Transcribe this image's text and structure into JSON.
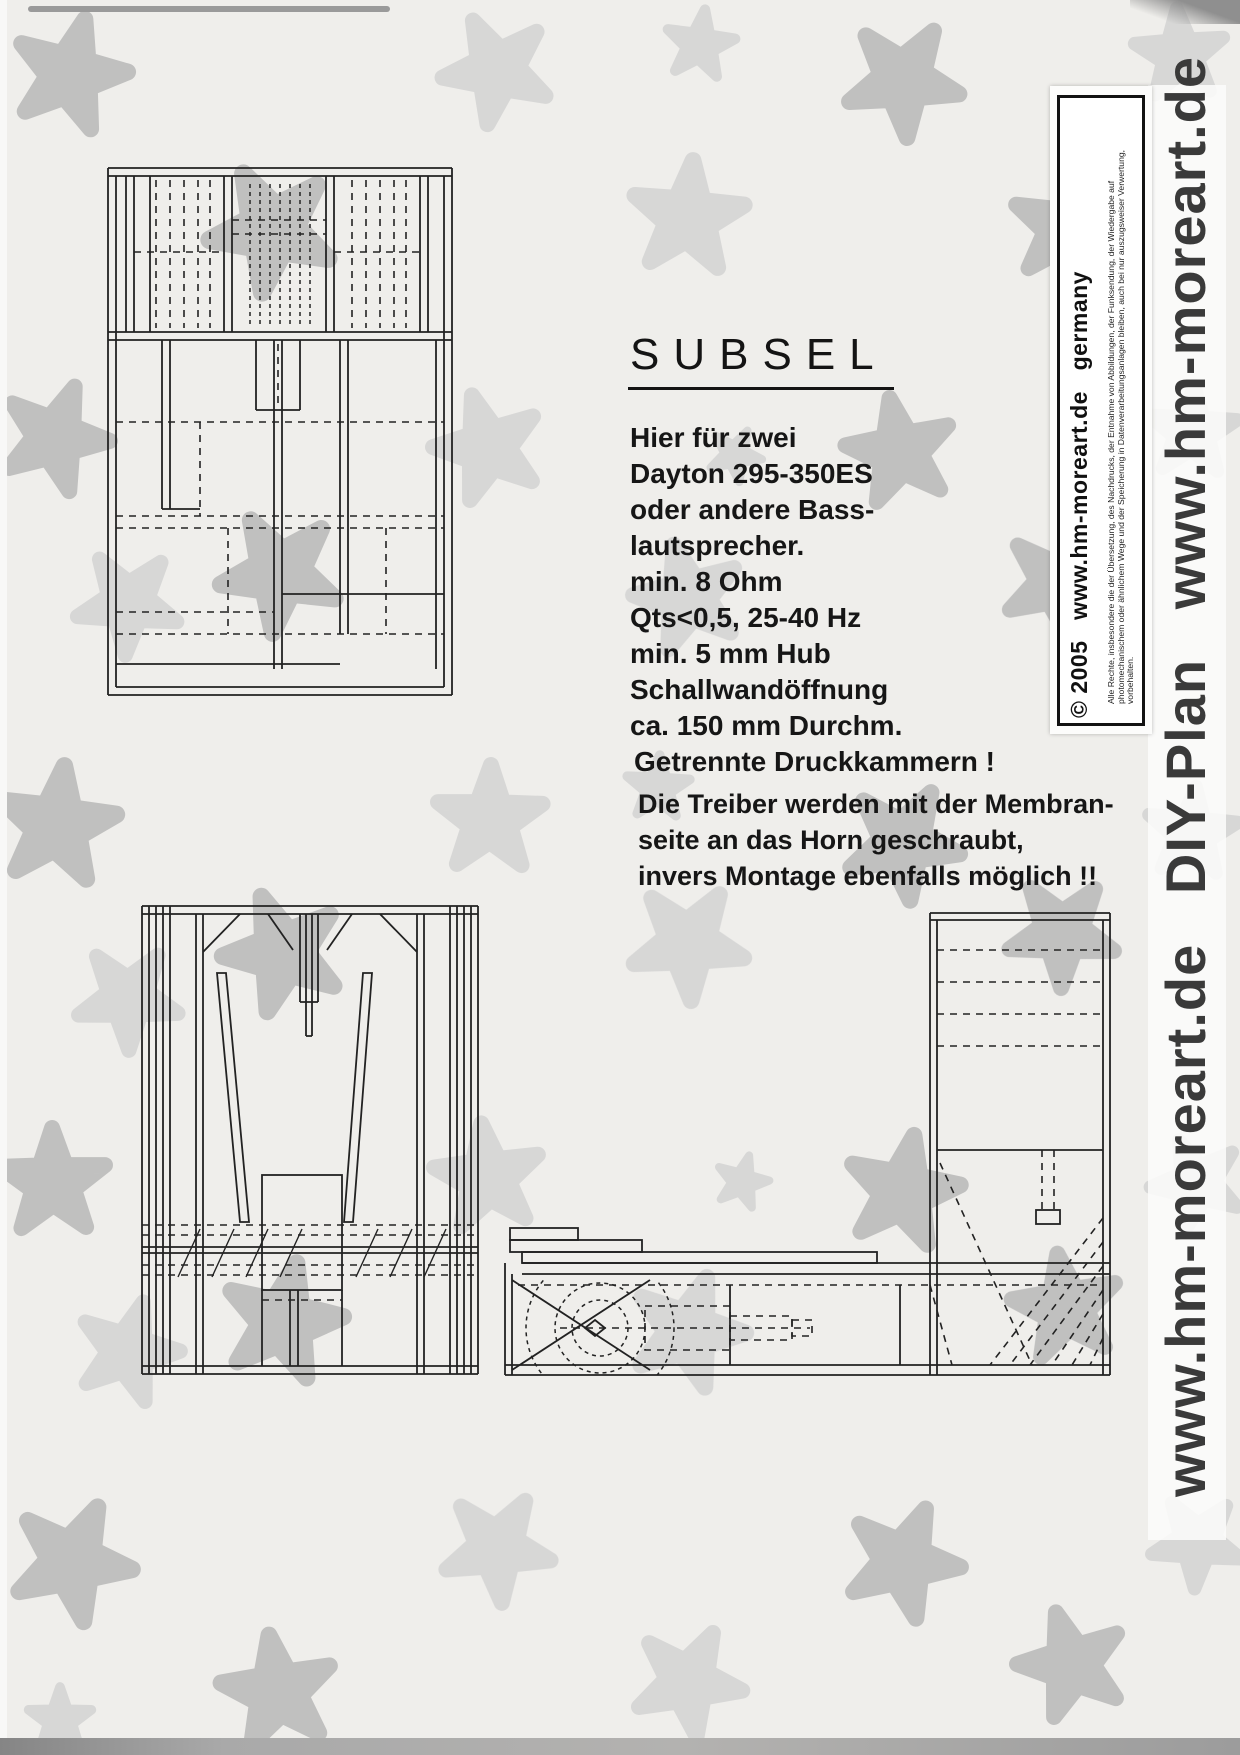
{
  "page": {
    "bg_color": "#efeeeb",
    "ink": "#1b1b1b",
    "title": "SUBSEL"
  },
  "specs": {
    "lines": [
      "Hier für zwei",
      "Dayton 295-350ES",
      "oder andere Bass-",
      "lautsprecher.",
      "min. 8 Ohm",
      "Qts<0,5, 25-40 Hz",
      "min. 5 mm Hub",
      "Schallwandöffnung",
      "ca. 150 mm Durchm."
    ]
  },
  "callout": "Getrennte Druckkammern !",
  "note_lines": [
    "Die Treiber werden mit der Membran-",
    "seite an das Horn geschraubt,",
    "invers Montage ebenfalls möglich !!"
  ],
  "copyright_label": {
    "main": "© 2005   www.hm-moreart.de   germany",
    "fine_print": "Alle Rechte, insbesondere die der Übersetzung, des Nachdrucks, der Entnahme von Abbildungen, der Funksendung, der Wiedergabe auf photomechanischem oder ähnlichem Wege und der Speicherung in Datenverarbeitungsanlagen bleiben, auch bei nur auszugsweiser Verwertung, vorbehalten."
  },
  "side_banner": "www.hm-moreart.de   DIY-Plan   www.hm-moreart.de",
  "background": {
    "tones": [
      "#b8b8b8",
      "#d3d3d3"
    ],
    "starfish": [
      [
        70,
        75,
        15,
        1.05,
        0
      ],
      [
        497,
        70,
        190,
        1.0,
        1
      ],
      [
        700,
        45,
        80,
        0.65,
        1
      ],
      [
        903,
        80,
        320,
        1.05,
        0
      ],
      [
        1180,
        55,
        140,
        0.85,
        1
      ],
      [
        272,
        230,
        45,
        1.15,
        0
      ],
      [
        688,
        218,
        5,
        1.05,
        1
      ],
      [
        1066,
        228,
        295,
        1.0,
        0
      ],
      [
        55,
        438,
        165,
        1.0,
        0
      ],
      [
        488,
        448,
        55,
        1.0,
        1
      ],
      [
        735,
        455,
        315,
        0.5,
        1
      ],
      [
        900,
        452,
        205,
        1.0,
        0
      ],
      [
        1192,
        432,
        75,
        0.85,
        1
      ],
      [
        128,
        603,
        255,
        0.95,
        1
      ],
      [
        280,
        573,
        115,
        1.1,
        0
      ],
      [
        688,
        598,
        345,
        1.0,
        1
      ],
      [
        1058,
        583,
        25,
        1.0,
        0
      ],
      [
        57,
        826,
        295,
        1.1,
        0
      ],
      [
        490,
        820,
        145,
        1.0,
        1
      ],
      [
        658,
        788,
        75,
        0.6,
        1
      ],
      [
        903,
        843,
        245,
        1.05,
        0
      ],
      [
        1192,
        833,
        5,
        0.85,
        1
      ],
      [
        128,
        998,
        35,
        0.95,
        1
      ],
      [
        283,
        953,
        195,
        1.1,
        0
      ],
      [
        688,
        943,
        105,
        1.05,
        1
      ],
      [
        1062,
        933,
        325,
        1.0,
        0
      ],
      [
        53,
        1183,
        215,
        1.0,
        0
      ],
      [
        488,
        1178,
        65,
        1.0,
        1
      ],
      [
        742,
        1182,
        15,
        0.5,
        1
      ],
      [
        903,
        1192,
        155,
        1.05,
        0
      ],
      [
        1197,
        1183,
        265,
        0.85,
        1
      ],
      [
        128,
        1352,
        305,
        0.95,
        1
      ],
      [
        283,
        1322,
        85,
        1.1,
        0
      ],
      [
        688,
        1332,
        235,
        1.05,
        1
      ],
      [
        1066,
        1308,
        135,
        1.0,
        0
      ],
      [
        72,
        1562,
        25,
        1.1,
        0
      ],
      [
        497,
        1548,
        175,
        1.0,
        1
      ],
      [
        903,
        1562,
        95,
        1.05,
        0
      ],
      [
        1197,
        1542,
        255,
        0.85,
        1
      ],
      [
        278,
        1692,
        135,
        1.05,
        0
      ],
      [
        688,
        1682,
        315,
        1.0,
        1
      ],
      [
        1072,
        1665,
        55,
        1.0,
        0
      ],
      [
        60,
        1720,
        0,
        0.6,
        1
      ]
    ]
  }
}
